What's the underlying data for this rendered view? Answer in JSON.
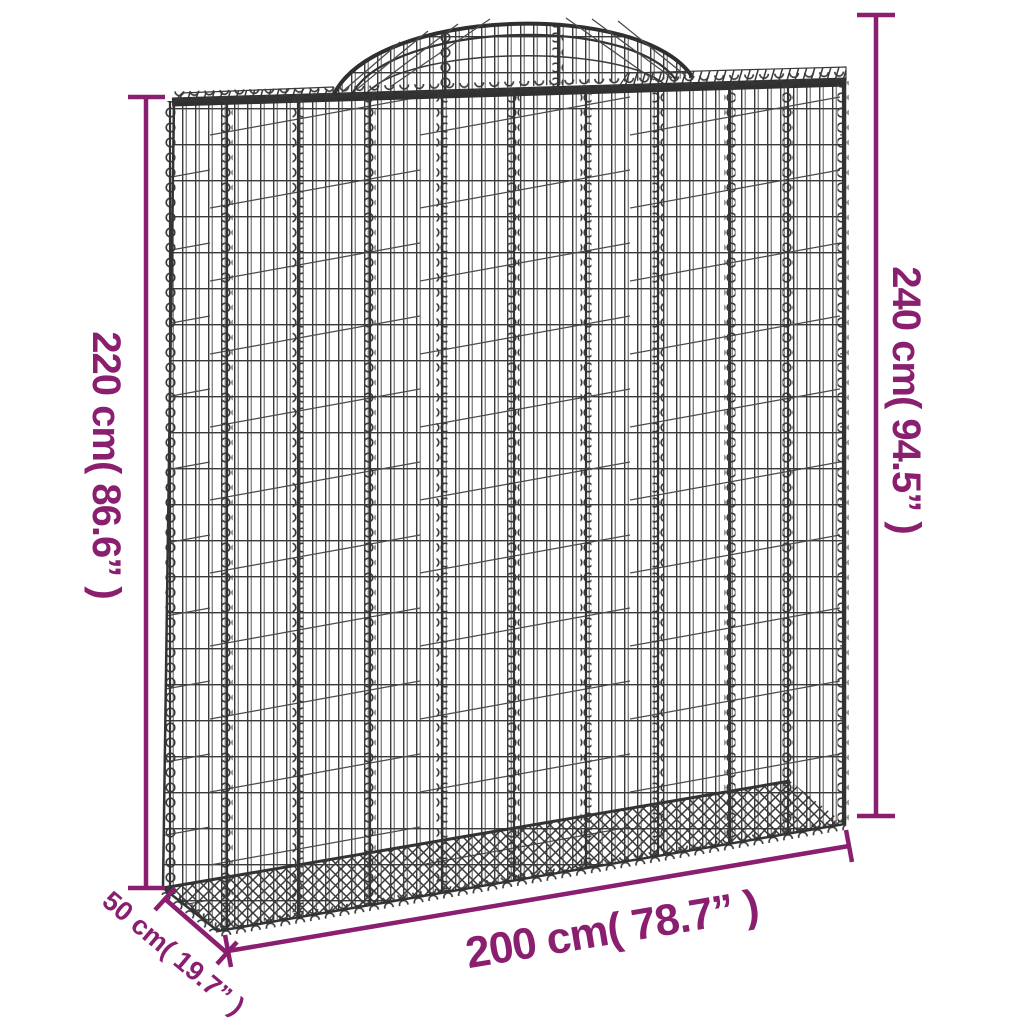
{
  "diagram": {
    "background_color": "#ffffff",
    "accent_color": "#8A1E6F",
    "wire_color": "#3a3a3a",
    "labels": {
      "left_height": "220 cm( 86.6” )",
      "right_height": "240 cm( 94.5” )",
      "bottom_width": "200 cm( 78.7” )",
      "depth": "50 cm( 19.7” )"
    }
  }
}
